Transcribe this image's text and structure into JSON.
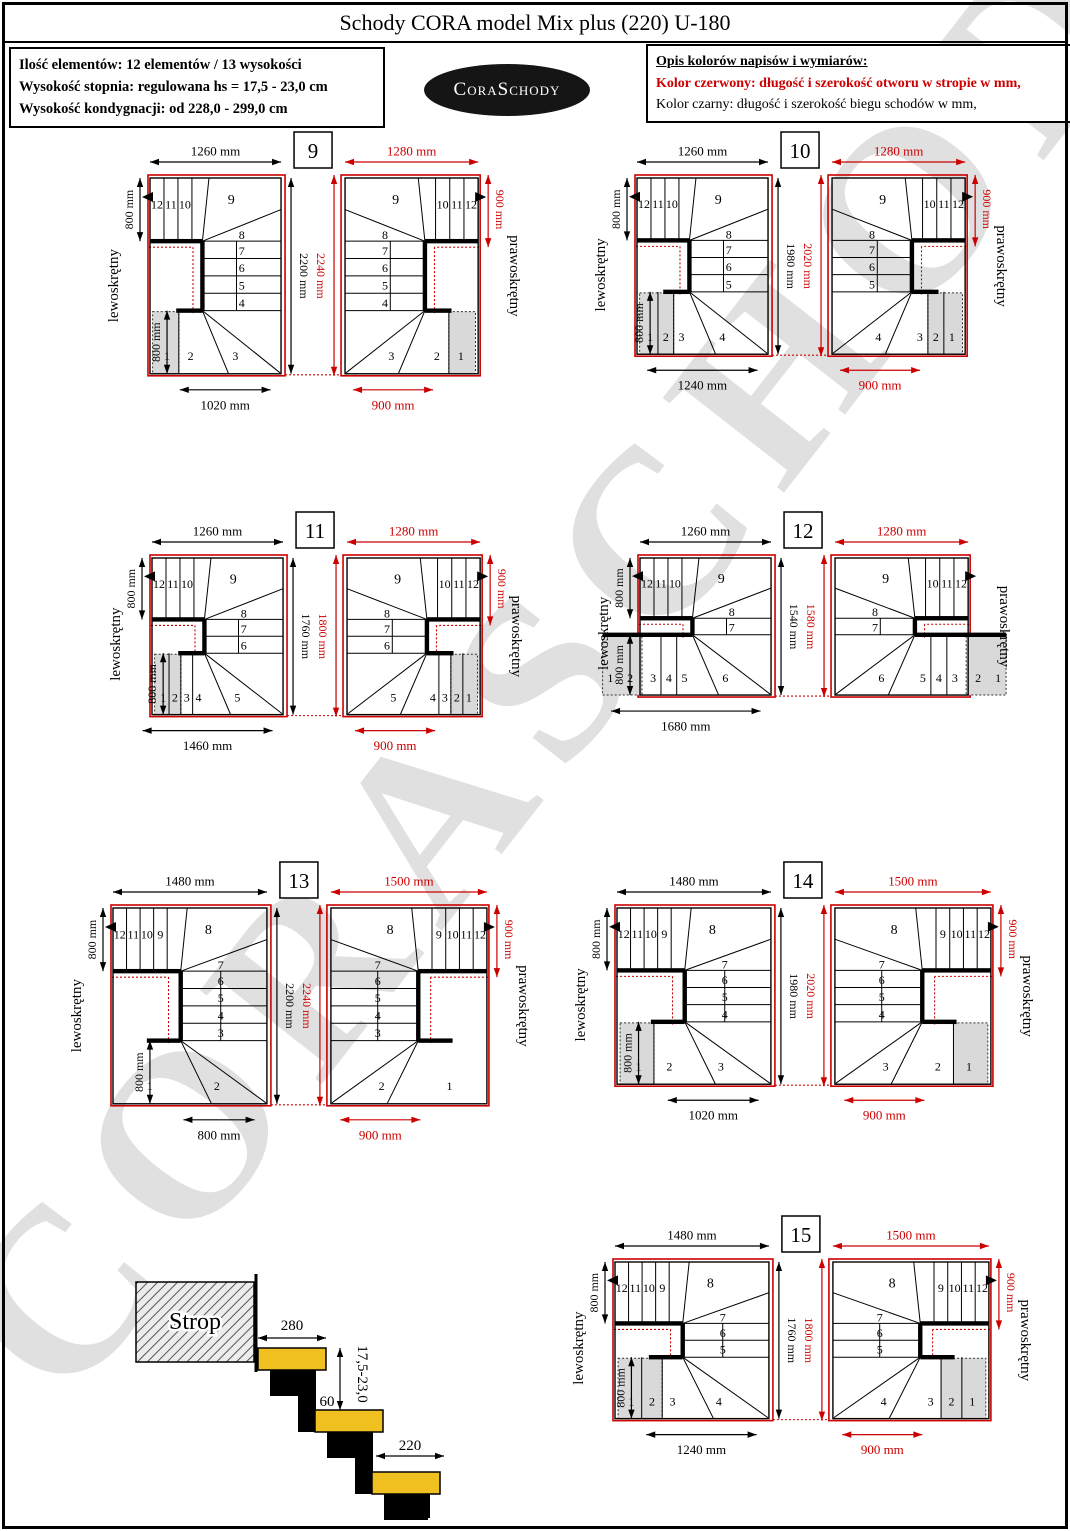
{
  "title": "Schody CORA model Mix plus (220) U-180",
  "info_box": {
    "lines": [
      "Ilość elementów: 12 elementów / 13 wysokości",
      "Wysokość stopnia: regulowana  hs = 17,5 - 23,0 cm",
      "Wysokość kondygnacji: od 228,0 - 299,0 cm"
    ]
  },
  "logo": {
    "text": "CoraSchody"
  },
  "legend_box": {
    "heading": "Opis kolorów napisów i wymiarów:",
    "red_line": "Kolor czerwony:  długość i szerokość otworu w stropie w mm,",
    "black_line": "Kolor czarny:  długość i szerokość biegu schodów w mm,"
  },
  "watermark": "CORASCHODY",
  "labels": {
    "left_turn": "lewoskrętny",
    "right_turn": "prawoskrętny"
  },
  "colors": {
    "red": "#cc0000",
    "black": "#000000",
    "shade": "#d9d9d9",
    "tread_yellow": "#f0c020"
  },
  "pairs": [
    {
      "number": "9",
      "heights": {
        "black": "2200 mm",
        "red": "2240 mm"
      },
      "left": {
        "top_dim": "1260 mm",
        "side_dim": "800 mm",
        "inner_dim": "800 mm",
        "bottom_dim": "1020 mm",
        "top_steps": [
          "12",
          "11",
          "10"
        ],
        "top_winder": "9",
        "col_steps": [
          "8",
          "7",
          "6",
          "5",
          "4"
        ],
        "bot_steps": [
          "1",
          "2",
          "3"
        ],
        "shaded": 1,
        "shade_outside": false
      },
      "right": {
        "top_dim": "1280 mm",
        "side_dim": "900 mm",
        "bottom_dim": "900 mm",
        "top_steps": [
          "12",
          "11",
          "10"
        ],
        "top_winder": "9",
        "col_steps": [
          "8",
          "7",
          "6",
          "5",
          "4"
        ],
        "bot_steps": [
          "1",
          "2",
          "3"
        ],
        "shaded": 1,
        "shade_outside": false
      }
    },
    {
      "number": "10",
      "heights": {
        "black": "1980 mm",
        "red": "2020 mm"
      },
      "left": {
        "top_dim": "1260 mm",
        "side_dim": "800 mm",
        "inner_dim": "800 mm",
        "bottom_dim": "1240 mm",
        "top_steps": [
          "12",
          "11",
          "10"
        ],
        "top_winder": "9",
        "col_steps": [
          "8",
          "7",
          "6",
          "5"
        ],
        "bot_steps": [
          "1",
          "2",
          "3",
          "4"
        ],
        "shaded": 2,
        "shade_outside": false
      },
      "right": {
        "top_dim": "1280 mm",
        "side_dim": "900 mm",
        "bottom_dim": "900 mm",
        "top_steps": [
          "12",
          "11",
          "10"
        ],
        "top_winder": "9",
        "col_steps": [
          "8",
          "7",
          "6",
          "5"
        ],
        "bot_steps": [
          "1",
          "2",
          "3",
          "4"
        ],
        "shaded": 2,
        "shade_outside": false
      }
    },
    {
      "number": "11",
      "heights": {
        "black": "1760 mm",
        "red": "1800 mm"
      },
      "left": {
        "top_dim": "1260 mm",
        "side_dim": "800 mm",
        "inner_dim": "800 mm",
        "bottom_dim": "1460 mm",
        "top_steps": [
          "12",
          "11",
          "10"
        ],
        "top_winder": "9",
        "col_steps": [
          "8",
          "7",
          "6"
        ],
        "bot_steps": [
          "1",
          "2",
          "3",
          "4",
          "5"
        ],
        "shaded": 2,
        "shade_outside": false
      },
      "right": {
        "top_dim": "1280 mm",
        "side_dim": "900 mm",
        "bottom_dim": "900 mm",
        "top_steps": [
          "12",
          "11",
          "10"
        ],
        "top_winder": "9",
        "col_steps": [
          "8",
          "7",
          "6"
        ],
        "bot_steps": [
          "1",
          "2",
          "3",
          "4",
          "5"
        ],
        "shaded": 2,
        "shade_outside": false
      }
    },
    {
      "number": "12",
      "heights": {
        "black": "1540 mm",
        "red": "1580 mm"
      },
      "left": {
        "top_dim": "1260 mm",
        "side_dim": "800 mm",
        "inner_dim": "800 mm",
        "bottom_dim": "1680 mm",
        "top_steps": [
          "12",
          "11",
          "10"
        ],
        "top_winder": "9",
        "col_steps": [
          "8",
          "7"
        ],
        "bot_steps": [
          "1",
          "2",
          "3",
          "4",
          "5",
          "6"
        ],
        "shaded": 2,
        "shade_outside": true
      },
      "right": {
        "top_dim": "1280 mm",
        "side_dim": null,
        "bottom_dim": null,
        "top_steps": [
          "12",
          "11",
          "10"
        ],
        "top_winder": "9",
        "col_steps": [
          "8",
          "7"
        ],
        "bot_steps": [
          "1",
          "2",
          "3",
          "4",
          "5",
          "6"
        ],
        "shaded": 2,
        "shade_outside": true
      }
    },
    {
      "number": "13",
      "heights": {
        "black": "2200 mm",
        "red": "2240 mm"
      },
      "left": {
        "top_dim": "1480 mm",
        "side_dim": "800 mm",
        "inner_dim": "800 mm",
        "bottom_dim": "800 mm",
        "top_steps": [
          "12",
          "11",
          "10",
          "9"
        ],
        "top_winder": "8",
        "col_steps": [
          "7",
          "6",
          "5",
          "4",
          "3"
        ],
        "bot_steps": [
          "1",
          "2"
        ],
        "shaded": 0,
        "shade_outside": false
      },
      "right": {
        "top_dim": "1500 mm",
        "side_dim": "900 mm",
        "bottom_dim": "900 mm",
        "top_steps": [
          "12",
          "11",
          "10",
          "9"
        ],
        "top_winder": "8",
        "col_steps": [
          "7",
          "6",
          "5",
          "4",
          "3"
        ],
        "bot_steps": [
          "1",
          "2"
        ],
        "shaded": 0,
        "shade_outside": false
      }
    },
    {
      "number": "14",
      "heights": {
        "black": "1980 mm",
        "red": "2020 mm"
      },
      "left": {
        "top_dim": "1480 mm",
        "side_dim": "800 mm",
        "inner_dim": "800 mm",
        "bottom_dim": "1020 mm",
        "top_steps": [
          "12",
          "11",
          "10",
          "9"
        ],
        "top_winder": "8",
        "col_steps": [
          "7",
          "6",
          "5",
          "4"
        ],
        "bot_steps": [
          "1",
          "2",
          "3"
        ],
        "shaded": 1,
        "shade_outside": false
      },
      "right": {
        "top_dim": "1500 mm",
        "side_dim": "900 mm",
        "bottom_dim": "900 mm",
        "top_steps": [
          "12",
          "11",
          "10",
          "9"
        ],
        "top_winder": "8",
        "col_steps": [
          "7",
          "6",
          "5",
          "4"
        ],
        "bot_steps": [
          "1",
          "2",
          "3"
        ],
        "shaded": 1,
        "shade_outside": false
      }
    },
    {
      "number": "15",
      "heights": {
        "black": "1760 mm",
        "red": "1800 mm"
      },
      "left": {
        "top_dim": "1480 mm",
        "side_dim": "800 mm",
        "inner_dim": "800 mm",
        "bottom_dim": "1240 mm",
        "top_steps": [
          "12",
          "11",
          "10",
          "9"
        ],
        "top_winder": "8",
        "col_steps": [
          "7",
          "6",
          "5"
        ],
        "bot_steps": [
          "1",
          "2",
          "3",
          "4"
        ],
        "shaded": 2,
        "shade_outside": false
      },
      "right": {
        "top_dim": "1500 mm",
        "side_dim": "900 mm",
        "bottom_dim": "900 mm",
        "top_steps": [
          "12",
          "11",
          "10",
          "9"
        ],
        "top_winder": "8",
        "col_steps": [
          "7",
          "6",
          "5"
        ],
        "bot_steps": [
          "1",
          "2",
          "3",
          "4"
        ],
        "shaded": 2,
        "shade_outside": false
      }
    }
  ],
  "section": {
    "strop": "Strop",
    "dim_tread_top": "280",
    "dim_overlap": "60",
    "dim_tread": "220",
    "dim_rise": "17,5-23,0"
  }
}
